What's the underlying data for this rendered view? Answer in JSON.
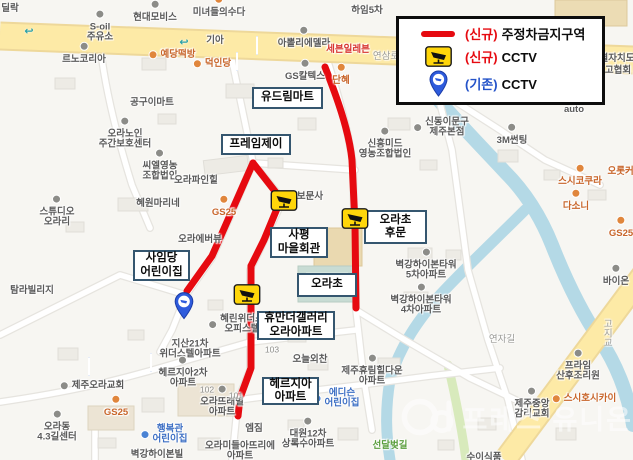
{
  "legend": {
    "items": [
      {
        "swatch": "red-line",
        "prefix": "(신규)",
        "prefix_color": "#e60a10",
        "label": "주정차금지구역"
      },
      {
        "swatch": "cctv-new",
        "prefix": "(신규)",
        "prefix_color": "#e60a10",
        "label": "CCTV"
      },
      {
        "swatch": "cctv-old",
        "prefix": "(기존)",
        "prefix_color": "#2453c9",
        "label": "CCTV"
      }
    ]
  },
  "annotations": {
    "boxed_labels": [
      {
        "text": "유드림마트",
        "x": 252,
        "y": 87,
        "w": 71,
        "h": 22
      },
      {
        "text": "프레임제이",
        "x": 221,
        "y": 134,
        "w": 70,
        "h": 21
      },
      {
        "text": "사평\n마을회관",
        "x": 270,
        "y": 227,
        "w": 58,
        "h": 31
      },
      {
        "text": "오라초\n후문",
        "x": 364,
        "y": 210,
        "w": 63,
        "h": 34
      },
      {
        "text": "오라초",
        "x": 297,
        "y": 273,
        "w": 60,
        "h": 24
      },
      {
        "text": "사임당\n어린이집",
        "x": 133,
        "y": 250,
        "w": 57,
        "h": 31
      },
      {
        "text": "휴만더갤러리\n오라아파트",
        "x": 257,
        "y": 311,
        "w": 78,
        "h": 29
      },
      {
        "text": "헤르지아\n아파트",
        "x": 262,
        "y": 377,
        "w": 57,
        "h": 28
      }
    ],
    "cctv_new": [
      {
        "x": 284,
        "y": 203
      },
      {
        "x": 355,
        "y": 221
      },
      {
        "x": 247,
        "y": 297
      }
    ],
    "cctv_old": [
      {
        "x": 184,
        "y": 322
      }
    ]
  },
  "map": {
    "pois": [
      {
        "text": "딜락",
        "x": 10,
        "y": 9
      },
      {
        "text": "현대모비스",
        "x": 155,
        "y": 18,
        "icon": "dot-gray"
      },
      {
        "text": "S-oil\n주유소",
        "x": 100,
        "y": 33,
        "icon": "dot-gray"
      },
      {
        "text": "르노코리아",
        "x": 84,
        "y": 60,
        "icon": "dot-gray"
      },
      {
        "text": "예당떡방",
        "x": 178,
        "y": 55,
        "cls": "orange",
        "icon": "dot-orange",
        "side": "left"
      },
      {
        "text": "미녀들의수다",
        "x": 219,
        "y": 13,
        "icon": "dot-orange"
      },
      {
        "text": "기아",
        "x": 215,
        "y": 41
      },
      {
        "text": "아뽈리에델라",
        "x": 304,
        "y": 44,
        "icon": "dot-gray"
      },
      {
        "text": "세븐일레븐",
        "x": 348,
        "y": 50,
        "cls": "red"
      },
      {
        "text": "연삼로",
        "x": 386,
        "y": 57,
        "cls": "road"
      },
      {
        "text": "덕인당",
        "x": 218,
        "y": 64,
        "cls": "orange",
        "icon": "dot-orange",
        "side": "left"
      },
      {
        "text": "GS칼텍스",
        "x": 305,
        "y": 77,
        "icon": "dot-gray"
      },
      {
        "text": "단혜",
        "x": 341,
        "y": 81,
        "cls": "orange",
        "icon": "dot-orange"
      },
      {
        "text": "하임5차",
        "x": 367,
        "y": 11
      },
      {
        "text": "공구이마트",
        "x": 152,
        "y": 103
      },
      {
        "text": "오라노인\n주간보호센터",
        "x": 125,
        "y": 140,
        "icon": "dot-gray"
      },
      {
        "text": "씨엘영농\n조합법인",
        "x": 160,
        "y": 172,
        "icon": "dot-gray"
      },
      {
        "text": "혜원마리네",
        "x": 158,
        "y": 204
      },
      {
        "text": "스튜디오\n오라리",
        "x": 57,
        "y": 218,
        "icon": "dot-gray"
      },
      {
        "text": "탐라빌리지",
        "x": 32,
        "y": 291
      },
      {
        "text": "오라파인힐",
        "x": 196,
        "y": 181
      },
      {
        "text": "GS25",
        "x": 224,
        "y": 213,
        "cls": "orange",
        "icon": "dot-orange"
      },
      {
        "text": "오라에버뷰",
        "x": 200,
        "y": 240
      },
      {
        "text": "보문사",
        "x": 310,
        "y": 197,
        "icon": "dot-gray",
        "side": "left"
      },
      {
        "text": "신흥미드\n영농조합법인",
        "x": 385,
        "y": 150,
        "icon": "dot-gray"
      },
      {
        "text": "신동이문구\n제주본점",
        "x": 447,
        "y": 128,
        "icon": "dot-gray",
        "side": "left"
      },
      {
        "text": "3M썬팅",
        "x": 512,
        "y": 141,
        "icon": "dot-gray"
      },
      {
        "text": "auto",
        "x": 574,
        "y": 110
      },
      {
        "text": "별자치도",
        "x": 617,
        "y": 59
      },
      {
        "text": "고협회",
        "x": 618,
        "y": 71
      },
      {
        "text": "스시코쿠라",
        "x": 580,
        "y": 182,
        "cls": "orange",
        "icon": "dot-orange"
      },
      {
        "text": "오롯커피",
        "x": 625,
        "y": 172,
        "cls": "orange"
      },
      {
        "text": "다소니",
        "x": 576,
        "y": 207,
        "cls": "orange",
        "icon": "dot-orange"
      },
      {
        "text": "GS25",
        "x": 621,
        "y": 234,
        "cls": "orange",
        "icon": "dot-orange"
      },
      {
        "text": "바이온",
        "x": 616,
        "y": 282,
        "icon": "dot-gray"
      },
      {
        "text": "벽강하이본타워\n5차아파트",
        "x": 426,
        "y": 271,
        "icon": "dot-gray"
      },
      {
        "text": "벽강하이본타워\n4차아파트",
        "x": 421,
        "y": 306,
        "icon": "dot-gray"
      },
      {
        "text": "혜린위더스\n오피스텔",
        "x": 242,
        "y": 325,
        "icon": "dot-gray",
        "side": "left"
      },
      {
        "text": "지산21차\n위더스텔아파트",
        "x": 190,
        "y": 350
      },
      {
        "text": "헤르지아2차\n아파트",
        "x": 183,
        "y": 379,
        "icon": "dot-gray"
      },
      {
        "text": "제주오라교회",
        "x": 98,
        "y": 386,
        "icon": "dot-gray",
        "side": "left"
      },
      {
        "text": "GS25",
        "x": 116,
        "y": 413,
        "cls": "orange",
        "icon": "dot-orange"
      },
      {
        "text": "오라동\n4.3길센터",
        "x": 57,
        "y": 433,
        "icon": "dot-gray"
      },
      {
        "text": "행복관\n어린이집",
        "x": 170,
        "y": 435,
        "cls": "blue",
        "icon": "dot-blue",
        "side": "left"
      },
      {
        "text": "벽강하이본빌",
        "x": 157,
        "y": 455
      },
      {
        "text": "오라뜨래별\n아파트",
        "x": 222,
        "y": 408,
        "icon": "dot-gray"
      },
      {
        "text": "102",
        "x": 207,
        "y": 390,
        "cls": "small"
      },
      {
        "text": "101",
        "x": 236,
        "y": 396,
        "cls": "small"
      },
      {
        "text": "103",
        "x": 272,
        "y": 350,
        "cls": "small"
      },
      {
        "text": "오늘외찬",
        "x": 310,
        "y": 360
      },
      {
        "text": "제주휴림힐다운\n아파트",
        "x": 372,
        "y": 377,
        "icon": "dot-gray"
      },
      {
        "text": "에디슨\n어린이집",
        "x": 342,
        "y": 399,
        "cls": "blue",
        "icon": "dot-blue",
        "side": "left"
      },
      {
        "text": "엠짐",
        "x": 254,
        "y": 429
      },
      {
        "text": "대원12차\n상록수아파트",
        "x": 308,
        "y": 440,
        "icon": "dot-gray"
      },
      {
        "text": "오라미들아뜨리에\n아파트",
        "x": 240,
        "y": 452
      },
      {
        "text": "선달벚길",
        "x": 390,
        "y": 446,
        "cls": "green"
      },
      {
        "text": "제주중앙\n감리교회",
        "x": 532,
        "y": 410,
        "icon": "dot-gray"
      },
      {
        "text": "스시호시카이",
        "x": 590,
        "y": 399,
        "cls": "orange",
        "icon": "dot-orange",
        "side": "left"
      },
      {
        "text": "프라임\n산후조리원",
        "x": 578,
        "y": 372,
        "icon": "dot-gray"
      },
      {
        "text": "연자길",
        "x": 502,
        "y": 340,
        "cls": "road"
      },
      {
        "text": "고지교",
        "x": 606,
        "y": 333,
        "cls": "road",
        "vertical": true
      },
      {
        "text": "수이식품",
        "x": 484,
        "y": 458
      }
    ],
    "misc_icons": [
      {
        "type": "bus",
        "x": 256,
        "y": 37
      },
      {
        "type": "bus",
        "x": 234,
        "y": 53
      },
      {
        "type": "bus",
        "x": 84,
        "y": 358
      },
      {
        "type": "bus",
        "x": 144,
        "y": 354
      },
      {
        "type": "uturn",
        "x": 29,
        "y": 31
      },
      {
        "type": "uturn",
        "x": 184,
        "y": 42
      }
    ]
  },
  "watermark": {
    "text": "프레스 유니온"
  },
  "colors": {
    "no_parking_red": "#e60a10",
    "label_border": "#35566f",
    "cctv_yellow": "#ffd60a",
    "pin_blue": "#2e5bdc"
  }
}
